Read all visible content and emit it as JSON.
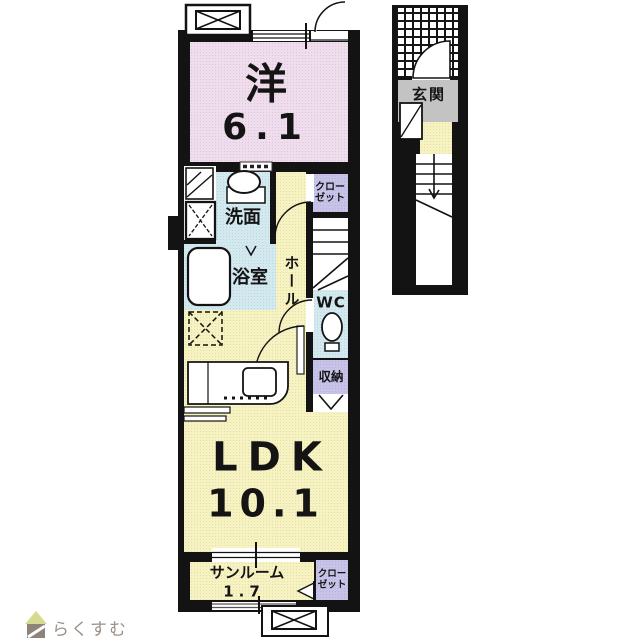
{
  "floorplan": {
    "unit": {
      "western_room": {
        "label": "洋",
        "size": "6.1"
      },
      "washroom": {
        "label": "洗面"
      },
      "bathroom": {
        "label": "浴室"
      },
      "hall": {
        "label": "ホール"
      },
      "closet_upper": {
        "line1": "クロー",
        "line2": "ゼット"
      },
      "wc": {
        "label": "WC"
      },
      "storage": {
        "label": "収納"
      },
      "ldk": {
        "label": "LDK",
        "size": "10.1"
      },
      "sunroom": {
        "label": "サンルーム",
        "size": "1.7"
      },
      "closet_lower": {
        "line1": "クロー",
        "line2": "ゼット"
      }
    },
    "entrance_section": {
      "entrance": {
        "label": "玄関"
      }
    },
    "colors": {
      "room_pink": "#efdcec",
      "room_yellow": "#f7f3c1",
      "wet_area_blue": "#d2e9f0",
      "closet_purple": "#c7c3e8",
      "entrance_gray": "#c3c3c3",
      "wall_black": "#131313",
      "logo_text_gray": "#9b9189",
      "logo_roof_green": "#d6da90",
      "logo_body_brown": "#8d8379"
    }
  },
  "watermark": {
    "text": "らくすむ"
  }
}
